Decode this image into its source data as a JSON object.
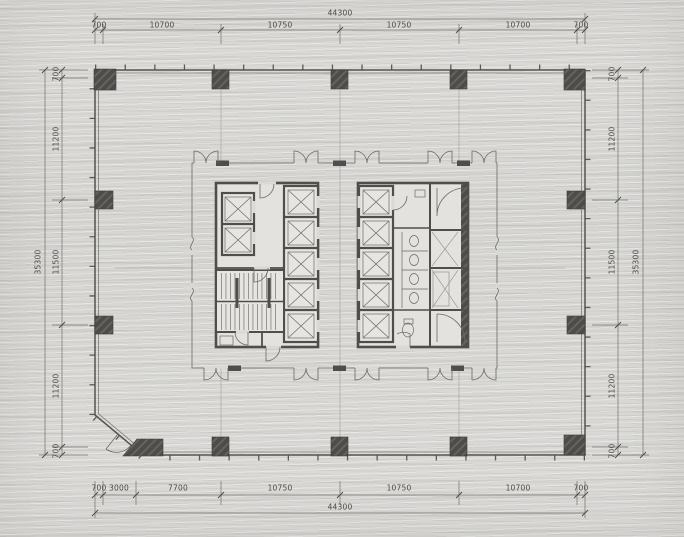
{
  "dimensions": {
    "top": {
      "total": "44300",
      "segments": [
        "700",
        "10700",
        "10750",
        "10750",
        "10700",
        "700"
      ]
    },
    "bottom": {
      "total": "44300",
      "segments": [
        "700",
        "3000",
        "7700",
        "10750",
        "10750",
        "10700",
        "700"
      ]
    },
    "left": {
      "total": "35300",
      "segments": [
        "700",
        "11200",
        "11500",
        "11200",
        "700"
      ]
    },
    "right": {
      "total": "35300",
      "segments": [
        "700",
        "11200",
        "11500",
        "11200",
        "700"
      ]
    }
  },
  "palette": {
    "paper": "#dad9d6",
    "ink": "#4b4a46",
    "wall": "#4f4e4c",
    "dimline": "#72716d"
  }
}
